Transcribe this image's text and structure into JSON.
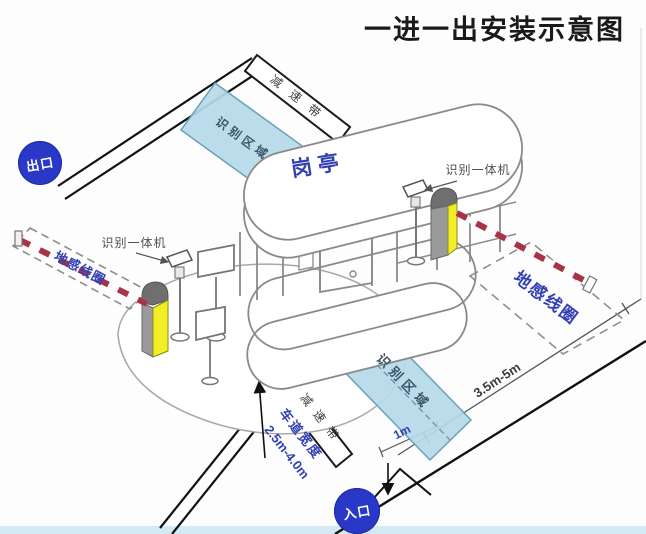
{
  "title": "一进一出安装示意图",
  "badges": {
    "exit": "出口",
    "entrance": "入口"
  },
  "booth": {
    "label": "岗亭"
  },
  "zones": {
    "recognition_exit": "识别区域",
    "recognition_entry": "识别区域",
    "coil_exit": "地感线圈",
    "coil_entry": "地感线圈"
  },
  "speed_bumps": {
    "exit": "减速带",
    "entry": "减速带"
  },
  "devices": {
    "reader_exit": "识别一体机",
    "reader_entry": "识别一体机"
  },
  "measurements": {
    "coil_to_barrier": "3.5m-5m",
    "stop_line": "1m",
    "lane_width_label": "车道宽度",
    "lane_width_value": "2.5m-4.0m"
  },
  "colors": {
    "label_blue": "#3240b4",
    "badge_blue": "#2a38c8",
    "zone_fill": "#b5d9e8",
    "zone_border": "#6aa0b8",
    "barrier_yellow": "#f2ee25",
    "arm_red": "#a83246",
    "title_black": "#1a1a1a"
  }
}
